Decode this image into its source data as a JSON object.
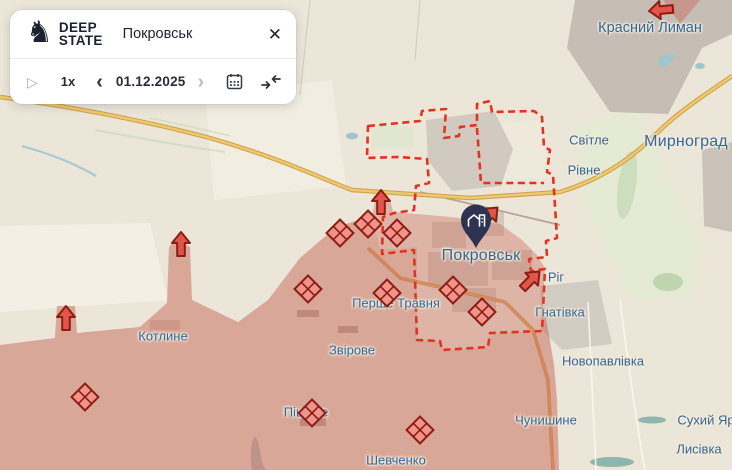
{
  "app": {
    "brand": {
      "line1": "DEEP",
      "line2": "STATE"
    },
    "search": {
      "value": "Покровськ"
    },
    "controls": {
      "speed": "1x",
      "date": "01.12.2025"
    },
    "icons": {
      "knight": "♞",
      "close": "✕",
      "play": "▷",
      "prev": "‹",
      "next": "›",
      "calendar": "calendar-icon",
      "merge": "jump-to-date-icon"
    }
  },
  "map": {
    "colors": {
      "base": "#ece6d9",
      "occupied": "rgba(200,104,88,0.40)",
      "frontline_dash": "#e2331f",
      "marker_red": "#e0564a",
      "marker_outline": "#8c1d12",
      "label_blue": "#38668f",
      "pin_navy": "#2d3350",
      "road_yellow": "#edc96f",
      "urban_gray": "#c6bdb5",
      "water_blue": "#9ec6cf",
      "green": "#c8dcba"
    },
    "labels": [
      {
        "text": "Красний Лиман",
        "x": 650,
        "y": 28,
        "size": "town-lg"
      },
      {
        "text": "Світле",
        "x": 589,
        "y": 140,
        "size": "town"
      },
      {
        "text": "Мирноград",
        "x": 686,
        "y": 142,
        "size": "city"
      },
      {
        "text": "Рівне",
        "x": 584,
        "y": 170,
        "size": "town"
      },
      {
        "text": "Покровськ",
        "x": 481,
        "y": 256,
        "size": "city"
      },
      {
        "text": "Ріг",
        "x": 556,
        "y": 277,
        "size": "town"
      },
      {
        "text": "Гнатівка",
        "x": 560,
        "y": 312,
        "size": "town"
      },
      {
        "text": "Перше Травня",
        "x": 396,
        "y": 303,
        "size": "town"
      },
      {
        "text": "Котлине",
        "x": 163,
        "y": 336,
        "size": "town"
      },
      {
        "text": "Звірове",
        "x": 352,
        "y": 350,
        "size": "town"
      },
      {
        "text": "Новопавлівка",
        "x": 603,
        "y": 361,
        "size": "town"
      },
      {
        "text": "Піщане",
        "x": 306,
        "y": 412,
        "size": "town"
      },
      {
        "text": "Чунишине",
        "x": 546,
        "y": 420,
        "size": "town"
      },
      {
        "text": "Сухий Яр",
        "x": 706,
        "y": 420,
        "size": "town"
      },
      {
        "text": "Шевченко",
        "x": 396,
        "y": 460,
        "size": "town"
      },
      {
        "text": "Лисівка",
        "x": 699,
        "y": 449,
        "size": "town"
      }
    ],
    "diamond_markers": [
      {
        "x": 340,
        "y": 233
      },
      {
        "x": 368,
        "y": 224
      },
      {
        "x": 397,
        "y": 233
      },
      {
        "x": 308,
        "y": 289
      },
      {
        "x": 387,
        "y": 293
      },
      {
        "x": 453,
        "y": 290
      },
      {
        "x": 482,
        "y": 312
      },
      {
        "x": 85,
        "y": 397
      },
      {
        "x": 312,
        "y": 413
      },
      {
        "x": 420,
        "y": 430
      }
    ],
    "arrow_markers": [
      {
        "x": 66,
        "y": 318,
        "rot": 0
      },
      {
        "x": 181,
        "y": 244,
        "rot": 0
      },
      {
        "x": 381,
        "y": 202,
        "rot": 0
      },
      {
        "x": 489,
        "y": 216,
        "rot": 45
      },
      {
        "x": 531,
        "y": 280,
        "rot": 45
      },
      {
        "x": 661,
        "y": 10,
        "rot": -95
      }
    ],
    "pin": {
      "x": 476,
      "y": 248,
      "place": "Покровськ"
    }
  }
}
